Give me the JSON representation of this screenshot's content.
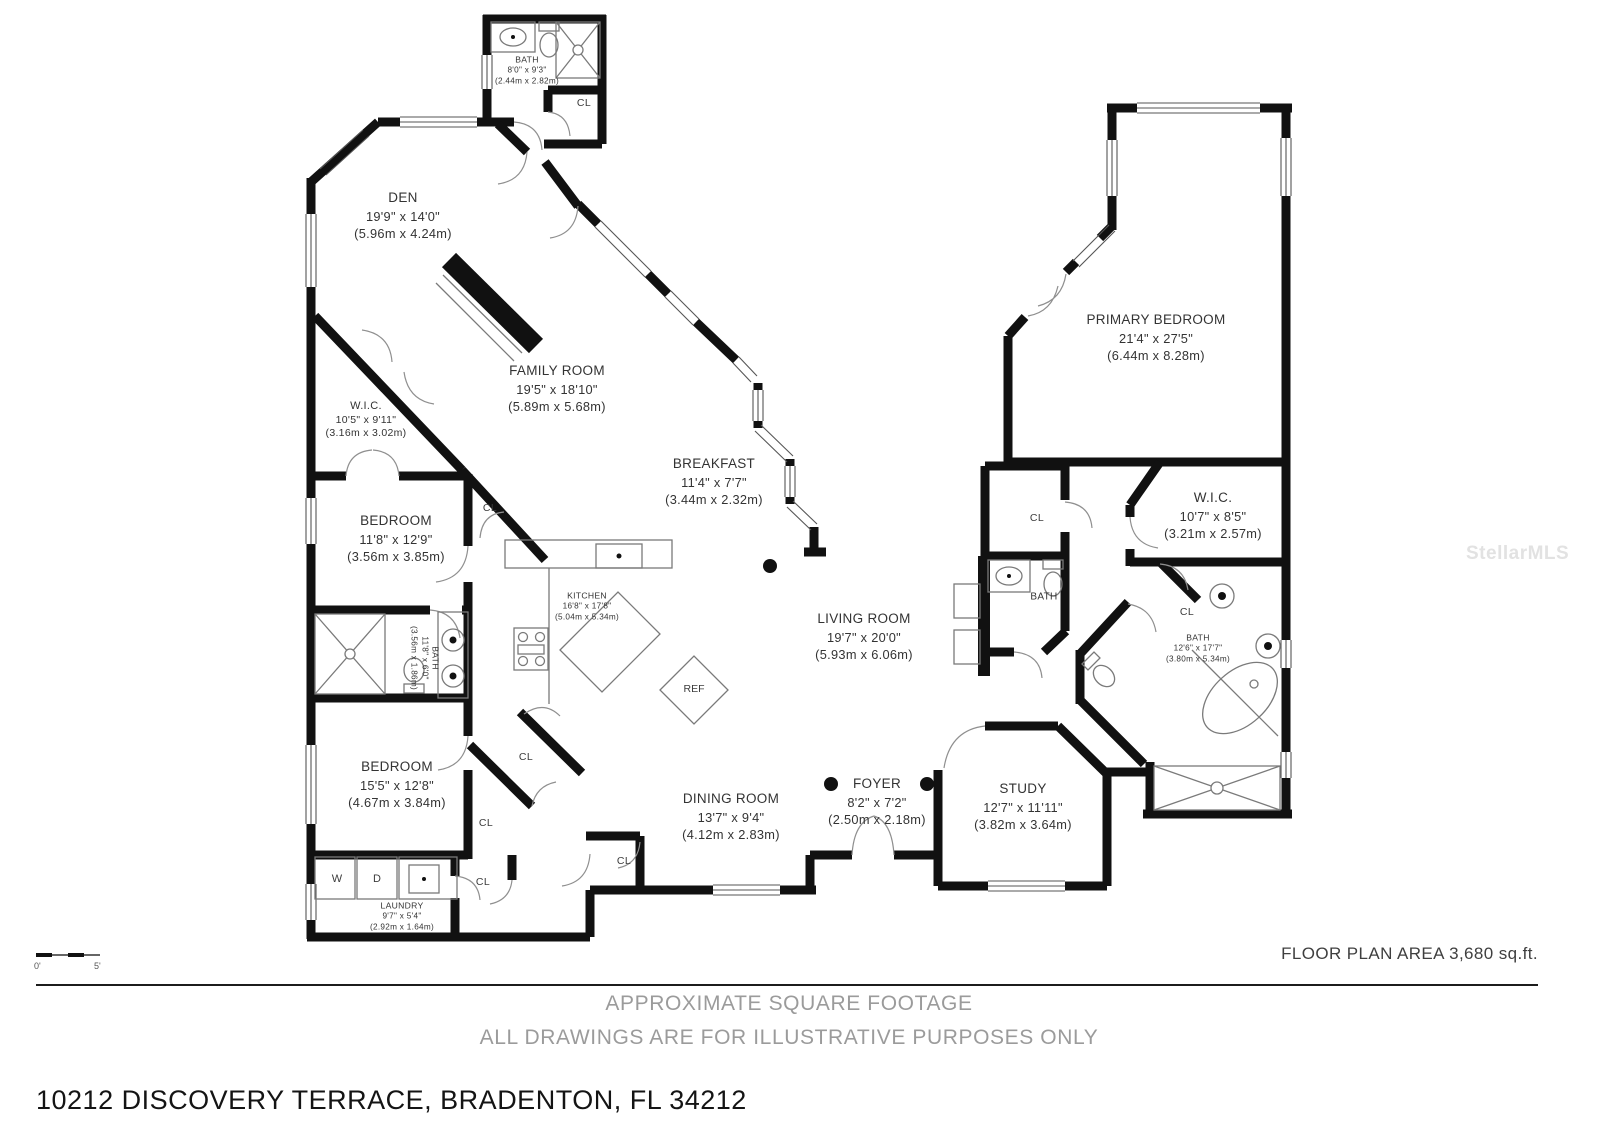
{
  "watermark": "StellarMLS",
  "closet_label": "CL",
  "appliances": {
    "washer": "W",
    "dryer": "D",
    "fridge": "REF"
  },
  "rooms": {
    "bath_top": {
      "name": "BATH",
      "dims": "8'0\" x 9'3\"",
      "metric": "(2.44m x 2.82m)"
    },
    "den": {
      "name": "DEN",
      "dims": "19'9\" x 14'0\"",
      "metric": "(5.96m x 4.24m)"
    },
    "family": {
      "name": "FAMILY ROOM",
      "dims": "19'5\" x 18'10\"",
      "metric": "(5.89m x 5.68m)"
    },
    "wic_left": {
      "name": "W.I.C.",
      "dims": "10'5\" x 9'11\"",
      "metric": "(3.16m x 3.02m)"
    },
    "bedroom1": {
      "name": "BEDROOM",
      "dims": "11'8\" x 12'9\"",
      "metric": "(3.56m x 3.85m)"
    },
    "bath_left": {
      "name": "BATH",
      "dims": "11'8\" x 6'0\"",
      "metric": "(3.56m x 1.86m)"
    },
    "bedroom2": {
      "name": "BEDROOM",
      "dims": "15'5\" x 12'8\"",
      "metric": "(4.67m x 3.84m)"
    },
    "laundry": {
      "name": "LAUNDRY",
      "dims": "9'7\" x 5'4\"",
      "metric": "(2.92m x 1.64m)"
    },
    "kitchen": {
      "name": "KITCHEN",
      "dims": "16'8\" x 17'8\"",
      "metric": "(5.04m x 5.34m)"
    },
    "breakfast": {
      "name": "BREAKFAST",
      "dims": "11'4\" x 7'7\"",
      "metric": "(3.44m x 2.32m)"
    },
    "living": {
      "name": "LIVING ROOM",
      "dims": "19'7\" x 20'0\"",
      "metric": "(5.93m x 6.06m)"
    },
    "dining": {
      "name": "DINING ROOM",
      "dims": "13'7\" x 9'4\"",
      "metric": "(4.12m x 2.83m)"
    },
    "foyer": {
      "name": "FOYER",
      "dims": "8'2\" x 7'2\"",
      "metric": "(2.50m x 2.18m)"
    },
    "study": {
      "name": "STUDY",
      "dims": "12'7\" x 11'11\"",
      "metric": "(3.82m x 3.64m)"
    },
    "primary": {
      "name": "PRIMARY BEDROOM",
      "dims": "21'4\" x 27'5\"",
      "metric": "(6.44m x 8.28m)"
    },
    "wic_right": {
      "name": "W.I.C.",
      "dims": "10'7\" x 8'5\"",
      "metric": "(3.21m x 2.57m)"
    },
    "bath_right": {
      "name": "BATH",
      "dims": "12'6\" x 17'7\"",
      "metric": "(3.80m x 5.34m)"
    },
    "bath_small": {
      "name": "BATH"
    }
  },
  "footer": {
    "scale_zero": "0'",
    "scale_five": "5'",
    "area_label": "FLOOR PLAN AREA 3,680 sq.ft.",
    "note_line1": "APPROXIMATE SQUARE FOOTAGE",
    "note_line2": "ALL DRAWINGS ARE FOR ILLUSTRATIVE PURPOSES ONLY",
    "address": "10212 DISCOVERY TERRACE, BRADENTON, FL 34212"
  }
}
